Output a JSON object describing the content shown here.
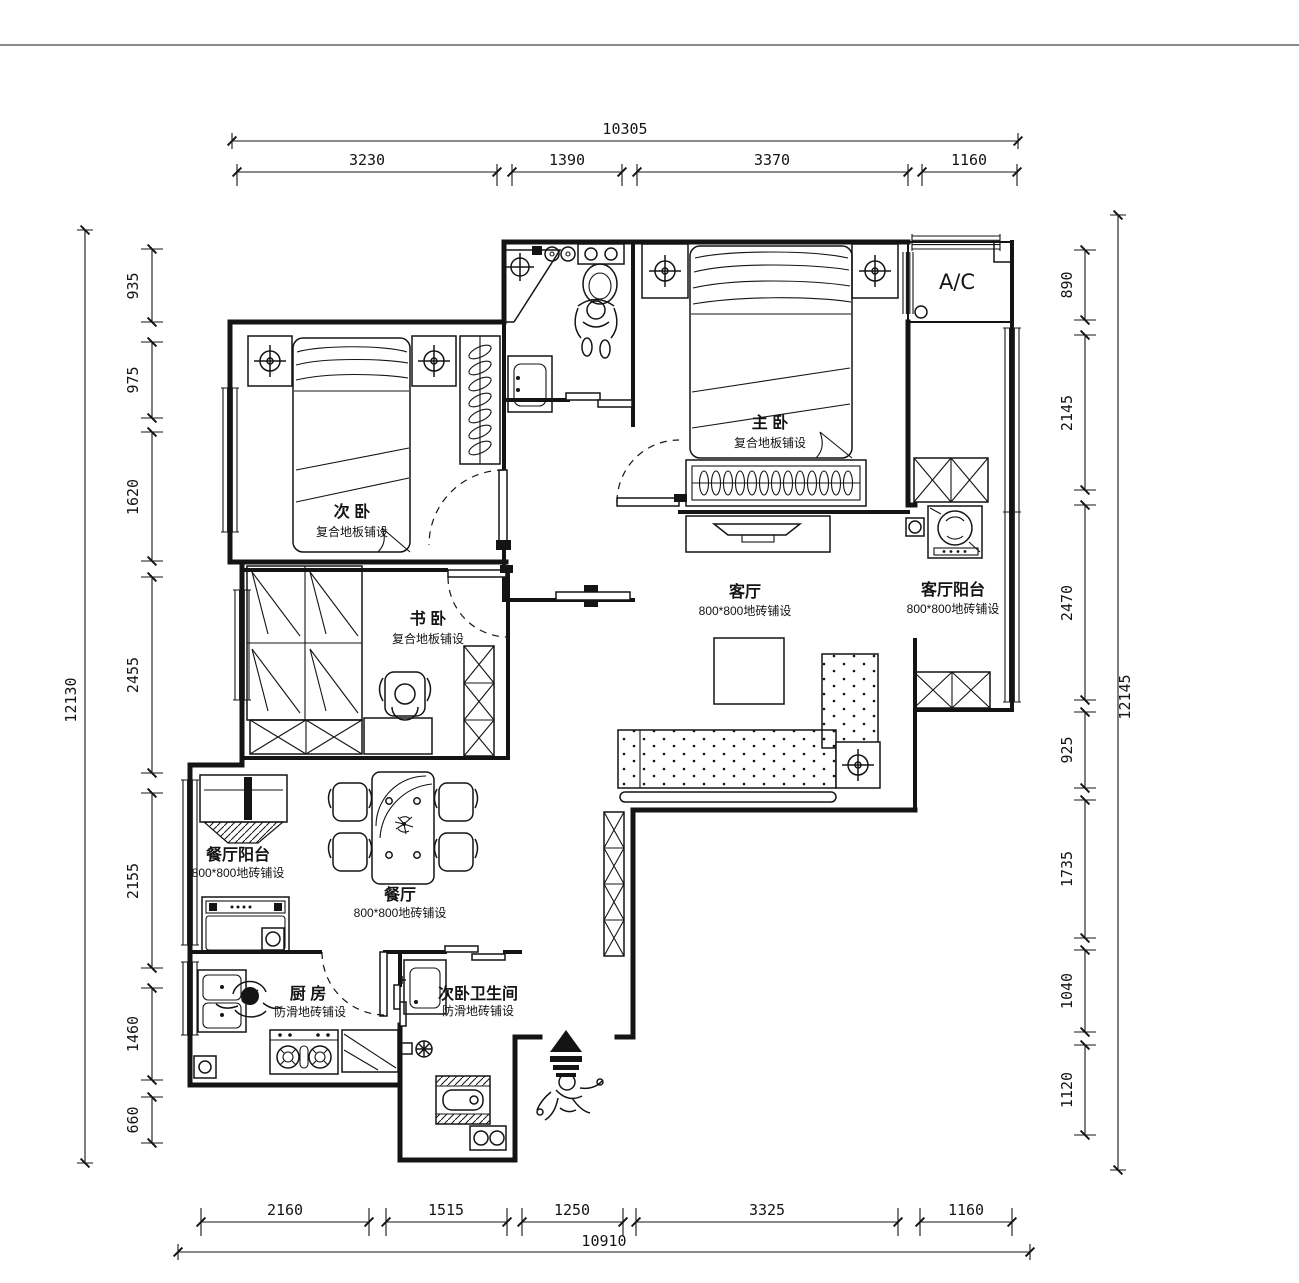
{
  "plan": {
    "background": "#ffffff",
    "ink": "#141414",
    "rooms": {
      "master_bedroom": {
        "name": "主 卧",
        "floor": "复合地板铺设"
      },
      "second_bedroom": {
        "name": "次 卧",
        "floor": "复合地板铺设"
      },
      "study_bedroom": {
        "name": "书 卧",
        "floor": "复合地板铺设"
      },
      "living_room": {
        "name": "客厅",
        "floor": "800*800地砖铺设"
      },
      "living_balcony": {
        "name": "客厅阳台",
        "floor": "800*800地砖铺设"
      },
      "dining_balcony": {
        "name": "餐厅阳台",
        "floor": "800*800地砖铺设"
      },
      "dining_room": {
        "name": "餐厅",
        "floor": "800*800地砖铺设"
      },
      "kitchen": {
        "name": "厨 房",
        "floor": "防滑地砖铺设"
      },
      "second_bathroom": {
        "name": "次卧卫生间",
        "floor": "防滑地砖铺设"
      },
      "ac_platform": {
        "name": "A/C"
      }
    },
    "dimensions": {
      "top": {
        "total": "10305",
        "segments": [
          "3230",
          "1390",
          "3370",
          "1160"
        ]
      },
      "bottom": {
        "total": "10910",
        "segments": [
          "2160",
          "1515",
          "1250",
          "3325",
          "1160"
        ]
      },
      "left": {
        "total": "12130",
        "segments": [
          "935",
          "975",
          "1620",
          "2455",
          "2155",
          "1460",
          "660"
        ]
      },
      "right": {
        "total": "12145",
        "segments": [
          "890",
          "2145",
          "2470",
          "925",
          "1735",
          "1040",
          "1120"
        ]
      }
    }
  }
}
